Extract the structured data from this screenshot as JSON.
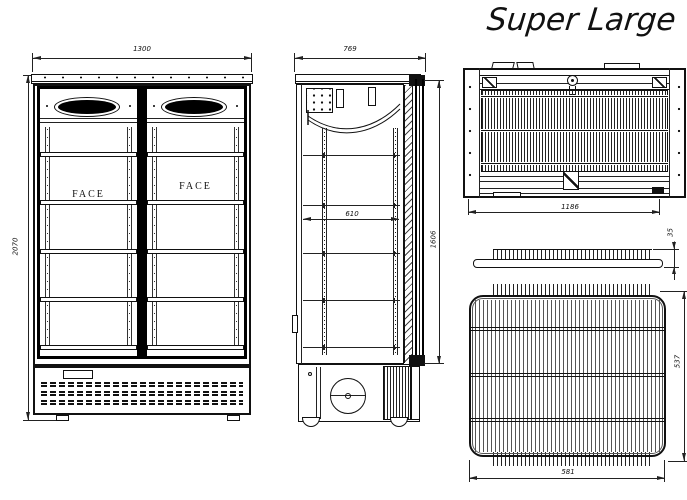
{
  "title": "Super Large",
  "front_view": {
    "width_mm": "1300",
    "height_mm": "2070",
    "door_brand_left": "FACE",
    "door_brand_right": "FACE"
  },
  "side_view": {
    "depth_mm": "769",
    "interior_depth_mm": "610",
    "door_height_mm": "1606"
  },
  "rear_view": {
    "condenser_width_mm": "1186"
  },
  "shelf_views": {
    "thickness_mm": "35",
    "width_mm": "581",
    "depth_mm": "537"
  }
}
